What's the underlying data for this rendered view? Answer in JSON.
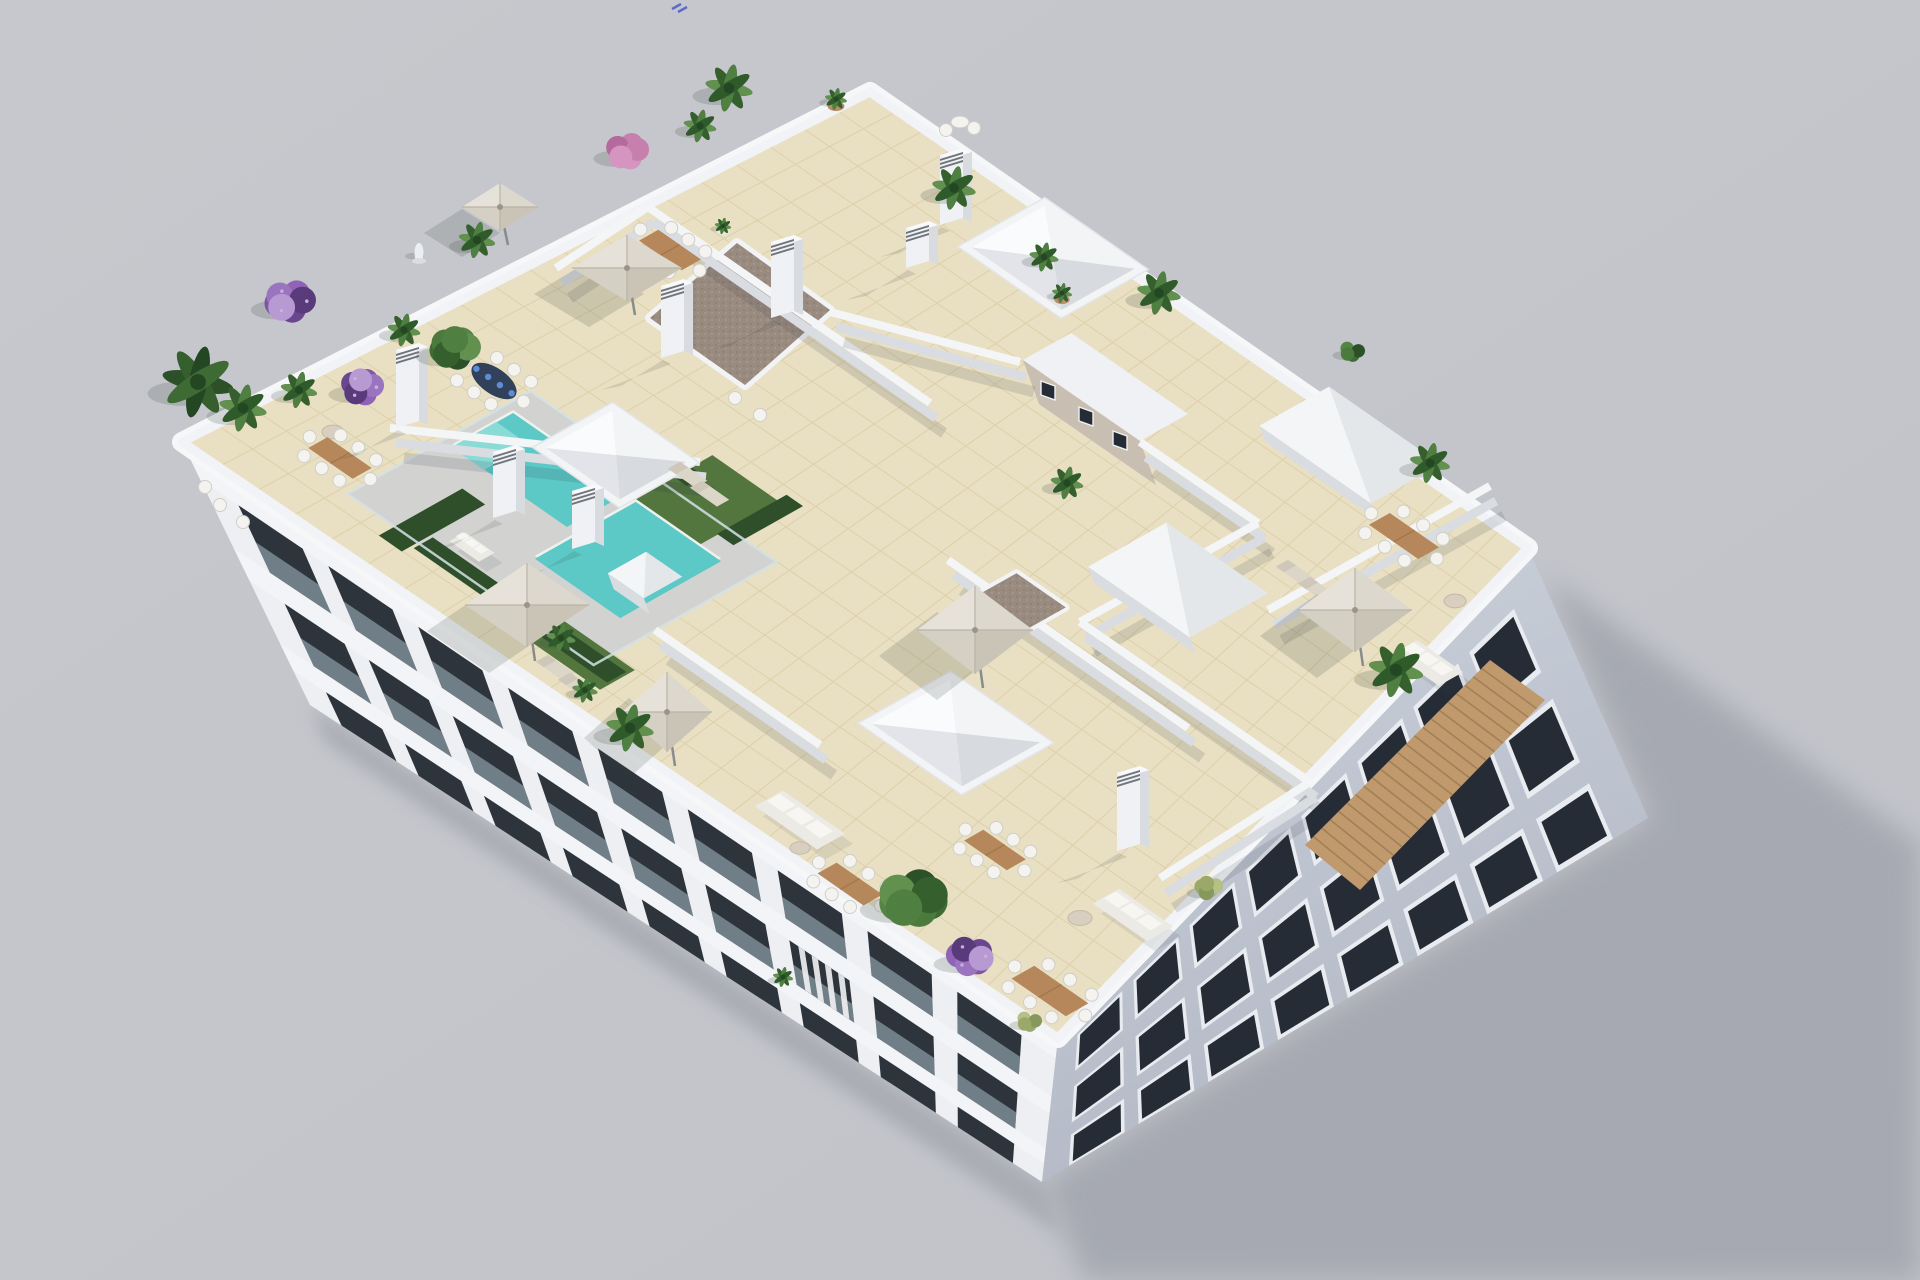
{
  "meta": {
    "description": "Aerial 3D render of a white apartment building rooftop terrace with L-shaped pool, beige tiled penthouse terraces, white parasols, wooden dining sets, palms and bougainvillea, soft shadow cast to the lower right on a plain light-gray ground",
    "width": 1920,
    "height": 1280
  },
  "palette": {
    "bg": "#c6c8cd",
    "bg_dark": "#c1c3c9",
    "ground_shadow": "#a4a7b0",
    "contact_shadow": "#a0a3ac",
    "cornice": "#f6f7f9",
    "parapet": "#f1f3f6",
    "wall_top": "#f4f5f7",
    "wall_face": "#d9dce1",
    "wall_shadow": "rgba(40,45,60,0.13)",
    "facade_lit": "#edeff2",
    "facade_band": "#f3f4f7",
    "facade_shade1": "#cdd3dc",
    "facade_shade2": "#b2b8c5",
    "window_dark": "#2e343c",
    "window_glass": "#262c35",
    "window_frame": "#e8ebf0",
    "balustrade": "#a8bcc6",
    "curtain": "#f2f2f4",
    "tile": "#e9dfc2",
    "tile_line": "#d9cba3",
    "deck": "#d2d3d1",
    "fence_glass": "#d4e2e6",
    "pool": "#5cc9c7",
    "pool_light": "#8fdcd7",
    "pool_edge": "#eef2ee",
    "turf": "#53763f",
    "hedge": "#2f4f2b",
    "gravel": "#9a8b81",
    "gravel_dot1": "#857567",
    "gravel_dot2": "#b2a396",
    "stucco": "#c9beb2",
    "clay": "#c0996d",
    "clay_dark": "#8f6f4c",
    "umbrella": "#ddd8ce",
    "umbrella_shade": "#cac4b6",
    "wood": "#b5875a",
    "wood_dark": "#a07548",
    "chair": "#f4f3f0",
    "sofa": "#eceae5",
    "cushion": "#f7f6f3",
    "lounger": "#dcd6c9",
    "chimney": "#eff1f4",
    "chimney_side": "#d8dbe0",
    "chimney_cap": "#70757c",
    "skylight_ne": "#f2f4f6",
    "skylight_se": "#d7dade",
    "skylight_sw": "#e2e4e9",
    "skylight_nw": "#fafbfd",
    "pot_terra": "#b98d6a",
    "pot_white": "#e9e6df",
    "artifact_blue": "#5b6bc8"
  },
  "scene": {
    "axes": {
      "aU": [
        0.82,
        0.57
      ],
      "bU": [
        -0.87,
        0.49
      ]
    },
    "roof": {
      "T": [
        870,
        92
      ],
      "R": [
        1528,
        548
      ],
      "B": [
        1058,
        1038
      ],
      "L": [
        182,
        442
      ],
      "tilesA": 24,
      "tilesB": 20
    },
    "ground_shadow": [
      [
        1545,
        575
      ],
      [
        1920,
        845
      ],
      [
        1920,
        1280
      ],
      [
        1085,
        1280
      ],
      [
        1042,
        1182
      ],
      [
        1648,
        818
      ]
    ],
    "contact_shadow": [
      [
        310,
        705
      ],
      [
        1042,
        1182
      ],
      [
        1060,
        1235
      ],
      [
        325,
        742
      ]
    ],
    "facade_left": {
      "quad": [
        [
          182,
          442
        ],
        [
          1058,
          1038
        ],
        [
          1042,
          1182
        ],
        [
          310,
          705
        ]
      ],
      "lean0": [
        128,
        265
      ],
      "lean1": [
        -16,
        146
      ],
      "rows": [
        [
          0.14,
          0.4
        ],
        [
          0.52,
          0.76
        ],
        [
          0.86,
          1.08
        ]
      ],
      "bay_start": 0.045,
      "bay_step": 0.105,
      "bay_width": 0.075,
      "bays": 9,
      "bands": [
        [
          0.4,
          0.52
        ],
        [
          0.76,
          0.86
        ],
        [
          0.02,
          0.14
        ]
      ],
      "curtain_bay": 6,
      "curtain_row": 1
    },
    "facade_right": {
      "quad": [
        [
          1058,
          1038
        ],
        [
          1528,
          548
        ],
        [
          1648,
          818
        ],
        [
          1042,
          1182
        ]
      ],
      "lean0": [
        -16,
        146
      ],
      "lean1": [
        122,
        272
      ],
      "rows": [
        [
          0.14,
          0.34
        ],
        [
          0.48,
          0.68
        ],
        [
          0.8,
          0.97
        ]
      ],
      "bay_start": 0.05,
      "bay_step": 0.115,
      "bay_width": 0.08,
      "bays": 8,
      "clay_strip": [
        [
          1305,
          845
        ],
        [
          1490,
          660
        ],
        [
          1545,
          700
        ],
        [
          1360,
          890
        ]
      ]
    },
    "deck": {
      "c": [
        562,
        528
      ],
      "la": 150,
      "lb": 105
    },
    "pool": {
      "bar": {
        "c": [
          540,
          470
        ],
        "la": 70,
        "lb": 35
      },
      "square": {
        "c": [
          628,
          560
        ],
        "la": 52,
        "lb": 58
      },
      "step": {
        "c": [
          490,
          446
        ],
        "la": 20,
        "lb": 26
      }
    },
    "turf": [
      {
        "c": [
          706,
          500
        ],
        "la": 40,
        "lb": 45
      },
      {
        "c": [
          560,
          640
        ],
        "la": 70,
        "lb": 20
      }
    ],
    "hedges": [
      {
        "c": [
          520,
          610
        ],
        "la": 118,
        "lb": 11
      },
      {
        "c": [
          432,
          520
        ],
        "la": 14,
        "lb": 48
      },
      {
        "c": [
          648,
          448
        ],
        "la": 58,
        "lb": 10
      },
      {
        "c": [
          760,
          520
        ],
        "la": 10,
        "lb": 40
      }
    ],
    "gravel": {
      "quad": [
        [
          737,
          243
        ],
        [
          830,
          310
        ],
        [
          745,
          385
        ],
        [
          650,
          318
        ]
      ]
    },
    "core": {
      "roof": [
        [
          1023,
          360
        ],
        [
          1140,
          441
        ],
        [
          1188,
          414
        ],
        [
          1071,
          333
        ]
      ],
      "face": [
        [
          1023,
          360
        ],
        [
          1140,
          441
        ],
        [
          1156,
          485
        ],
        [
          1039,
          404
        ]
      ],
      "windows": [
        [
          1048,
          390
        ],
        [
          1086,
          416
        ],
        [
          1120,
          440
        ]
      ]
    },
    "walls": [
      [
        648,
        207,
        930,
        403
      ],
      [
        556,
        268,
        648,
        207
      ],
      [
        390,
        428,
        700,
        462
      ],
      [
        830,
        312,
        1020,
        362
      ],
      [
        1140,
        442,
        1258,
        523
      ],
      [
        1258,
        523,
        1080,
        622
      ],
      [
        1490,
        486,
        1268,
        610
      ],
      [
        1080,
        622,
        1310,
        782
      ],
      [
        1310,
        782,
        1160,
        878
      ],
      [
        948,
        560,
        1188,
        728
      ],
      [
        655,
        630,
        820,
        745
      ]
    ],
    "bulkheads": [
      {
        "c": [
          1350,
          445
        ],
        "la": 68,
        "lb": 40
      },
      {
        "c": [
          1178,
          580
        ],
        "la": 62,
        "lb": 45
      },
      {
        "c": [
          645,
          575
        ],
        "la": 22,
        "lb": 22
      }
    ],
    "gravel_box": {
      "c": [
        1015,
        605
      ],
      "la": 30,
      "lb": 30
    },
    "skylights": [
      {
        "c": [
          1053,
          258
        ],
        "la": 55,
        "lb": 42
      },
      {
        "c": [
          616,
          455
        ],
        "la": 45,
        "lb": 38
      },
      {
        "c": [
          956,
          733
        ],
        "la": 55,
        "lb": 45
      }
    ],
    "chimneys": [
      [
        408,
        428,
        78
      ],
      [
        673,
        358,
        72
      ],
      [
        783,
        318,
        76
      ],
      [
        505,
        518,
        66
      ],
      [
        584,
        549,
        58
      ],
      [
        1129,
        851,
        78
      ],
      [
        952,
        225,
        70
      ],
      [
        918,
        268,
        40
      ]
    ],
    "tables": [
      {
        "c": [
          670,
          250
        ],
        "la": 26,
        "lb": 11,
        "kind": "wood"
      },
      {
        "c": [
          340,
          458
        ],
        "la": 27,
        "lb": 11,
        "kind": "wood"
      },
      {
        "c": [
          494,
          381
        ],
        "la": 26,
        "lb": 13,
        "kind": "navy"
      },
      {
        "c": [
          1404,
          536
        ],
        "la": 30,
        "lb": 12,
        "kind": "wood"
      },
      {
        "c": [
          1050,
          991
        ],
        "la": 33,
        "lb": 13,
        "kind": "wood"
      },
      {
        "c": [
          850,
          884
        ],
        "la": 28,
        "lb": 11,
        "kind": "wood"
      },
      {
        "c": [
          995,
          850
        ],
        "la": 26,
        "lb": 11,
        "kind": "wood"
      }
    ],
    "bistro": {
      "c": [
        960,
        122
      ],
      "r": 9
    },
    "sofas": [
      {
        "c": [
          800,
          820
        ],
        "la": 38,
        "lb": 16
      },
      {
        "c": [
          1133,
          915
        ],
        "la": 33,
        "lb": 15
      },
      {
        "c": [
          1428,
          663
        ],
        "la": 28,
        "lb": 14
      },
      {
        "c": [
          472,
          547
        ],
        "la": 18,
        "lb": 9
      }
    ],
    "round_tables": [
      [
        1080,
        918,
        12
      ],
      [
        800,
        848,
        10
      ],
      [
        1455,
        601,
        11
      ],
      [
        333,
        432,
        11
      ]
    ],
    "loungers": [
      [
        688,
        475
      ],
      [
        710,
        494
      ],
      [
        556,
        668
      ],
      [
        578,
        686
      ],
      [
        1296,
        573
      ],
      [
        1318,
        590
      ]
    ],
    "armchairs": [
      [
        220,
        505
      ],
      [
        243,
        522
      ],
      [
        205,
        487
      ],
      [
        735,
        398
      ],
      [
        760,
        415
      ]
    ],
    "umbrellas": [
      {
        "c": [
          627,
          268
        ],
        "rx": 55,
        "ry": 33
      },
      {
        "c": [
          527,
          605
        ],
        "rx": 62,
        "ry": 42
      },
      {
        "c": [
          667,
          712
        ],
        "rx": 45,
        "ry": 40
      },
      {
        "c": [
          975,
          630
        ],
        "rx": 58,
        "ry": 44
      },
      {
        "c": [
          1355,
          610
        ],
        "rx": 57,
        "ry": 42
      },
      {
        "c": [
          500,
          207
        ],
        "rx": 38,
        "ry": 24
      }
    ],
    "plants": [
      [
        198,
        382,
        36,
        "palmDark"
      ],
      [
        243,
        408,
        26,
        "palm"
      ],
      [
        299,
        390,
        20,
        "palm"
      ],
      [
        290,
        301,
        28,
        "bougain"
      ],
      [
        362,
        387,
        24,
        "bougain"
      ],
      [
        455,
        348,
        28,
        "tree"
      ],
      [
        404,
        330,
        18,
        "palm"
      ],
      [
        477,
        240,
        20,
        "palm"
      ],
      [
        627,
        151,
        24,
        "pink"
      ],
      [
        729,
        88,
        26,
        "palm"
      ],
      [
        700,
        126,
        18,
        "palm"
      ],
      [
        836,
        99,
        12,
        "potPlant"
      ],
      [
        954,
        188,
        24,
        "palm"
      ],
      [
        1044,
        257,
        16,
        "palm"
      ],
      [
        1062,
        293,
        11,
        "potPlant"
      ],
      [
        1159,
        293,
        24,
        "palm"
      ],
      [
        1352,
        351,
        14,
        "bush"
      ],
      [
        1430,
        463,
        22,
        "palm"
      ],
      [
        1067,
        483,
        18,
        "palm"
      ],
      [
        1396,
        670,
        30,
        "palm"
      ],
      [
        630,
        728,
        26,
        "palm"
      ],
      [
        913,
        898,
        38,
        "tree"
      ],
      [
        970,
        956,
        26,
        "bougain"
      ],
      [
        1209,
        888,
        16,
        "bushLight"
      ],
      [
        1029,
        1021,
        14,
        "bushLight"
      ],
      [
        783,
        977,
        11,
        "palm"
      ],
      [
        561,
        638,
        16,
        "palm"
      ],
      [
        585,
        690,
        14,
        "palm"
      ],
      [
        723,
        226,
        9,
        "potWhite"
      ],
      [
        419,
        253,
        10,
        "statue"
      ]
    ],
    "artifact": {
      "x": 672,
      "y": 4
    }
  }
}
